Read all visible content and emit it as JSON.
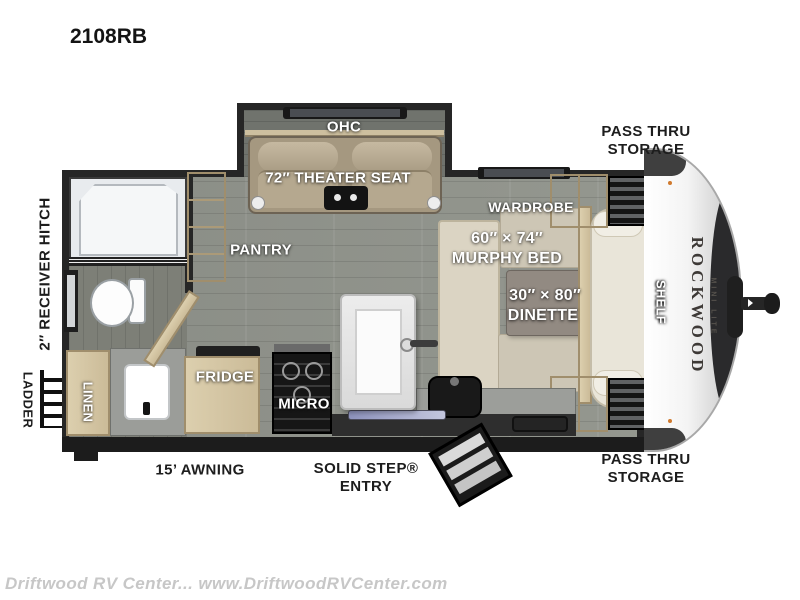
{
  "title": "2108RB",
  "watermark": "Driftwood RV Center... www.DriftwoodRVCenter.com",
  "brand": {
    "name": "ROCKWOOD",
    "sub": "MINI LITE"
  },
  "labels": {
    "ohc": "OHC",
    "theater_seat": "72″ THEATER SEAT",
    "pantry": "PANTRY",
    "wardrobe_top": "WARDROBE",
    "wardrobe_bottom": "WARDROBE",
    "murphy_bed_size": "60″ × 74″",
    "murphy_bed": "MURPHY BED",
    "dinette_size": "30″ × 80″",
    "dinette": "DINETTE",
    "shelf": "SHELF",
    "fridge": "FRIDGE",
    "micro": "MICRO",
    "tv": "TV",
    "linen": "LINEN",
    "receiver_hitch": "2″ RECEIVER HITCH",
    "ladder": "LADDER",
    "awning": "15’ AWNING",
    "entry_line1": "SOLID STEP®",
    "entry_line2": "ENTRY",
    "pass_thru_line1": "PASS THRU",
    "pass_thru_line2": "STORAGE"
  }
}
